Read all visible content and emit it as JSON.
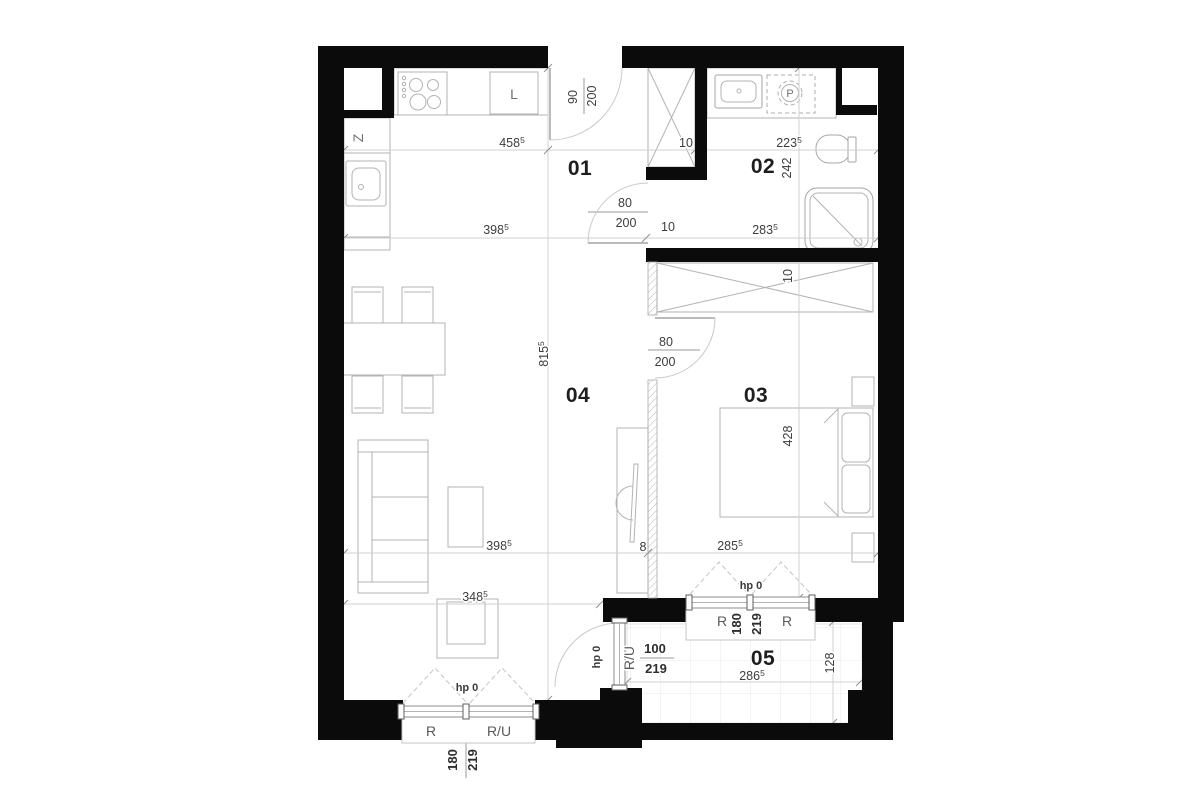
{
  "rooms": {
    "hall": "01",
    "bathroom": "02",
    "bedroom": "03",
    "living": "04",
    "balcony": "05"
  },
  "appliances": {
    "fridge": "L",
    "washing_machine": "P",
    "kitchen_unit": "Z"
  },
  "dims": {
    "kitchen_upper": {
      "v": "458",
      "sup": "5"
    },
    "kitchen_lower": {
      "v": "398",
      "sup": "5"
    },
    "apartment_depth": {
      "v": "815",
      "sup": "5"
    },
    "bath_upper": {
      "v": "223",
      "sup": "5"
    },
    "bath_lower": {
      "v": "283",
      "sup": "5"
    },
    "bath_depth": {
      "v": "242",
      "sup": ""
    },
    "bedroom_depth": {
      "v": "428",
      "sup": ""
    },
    "bedroom_width": {
      "v": "285",
      "sup": "5"
    },
    "living_width": {
      "v": "398",
      "sup": "5"
    },
    "partition": {
      "v": "8",
      "sup": ""
    },
    "living_lower": {
      "v": "348",
      "sup": "5"
    },
    "balcony_width": {
      "v": "286",
      "sup": "5"
    },
    "balcony_depth": {
      "v": "128",
      "sup": ""
    },
    "wall_hall": "10",
    "wall_bath": "10",
    "wall_bedroom": "10"
  },
  "doors": {
    "entrance": {
      "w": "90",
      "h": "200"
    },
    "bathroom": {
      "w": "80",
      "h": "200"
    },
    "bedroom": {
      "w": "80",
      "h": "200"
    },
    "balcony": {
      "w": "100",
      "h": "219",
      "type": "R/U",
      "parapet": "hp 0"
    }
  },
  "windows": {
    "living": {
      "parapet": "hp 0",
      "left_type": "R",
      "right_type": "R/U",
      "w": "180",
      "h": "219"
    },
    "bedroom": {
      "parapet": "hp 0",
      "left_type": "R",
      "right_type": "R",
      "w": "180",
      "h": "219"
    }
  }
}
